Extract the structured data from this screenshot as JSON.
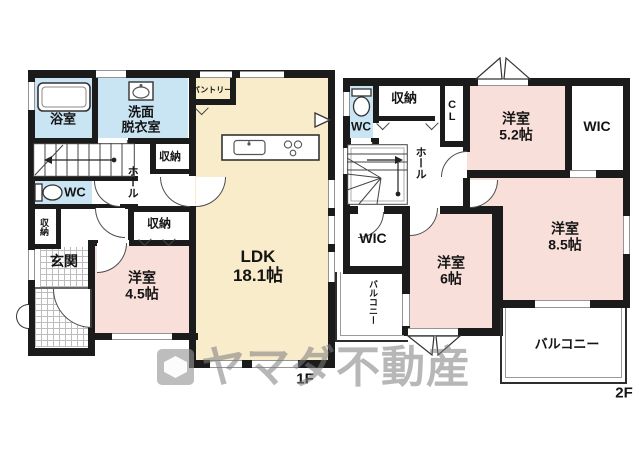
{
  "colors": {
    "wall": "#1b1b1b",
    "ldk": "#F8ECCB",
    "bedroom": "#F9DFD9",
    "wet": "#C9E4F2",
    "tile": "#bdbdbd",
    "wm": "#7d7d7d"
  },
  "floor1": {
    "label": "1F",
    "rooms": {
      "bath": {
        "label": "浴室"
      },
      "washroom": {
        "line1": "洗面",
        "line2": "脱衣室"
      },
      "pantry": {
        "label": "パントリー"
      },
      "storage_hall": {
        "label": "収納"
      },
      "hall": {
        "label": "ホール"
      },
      "wc": {
        "label": "WC"
      },
      "storage_side": {
        "label": "収納"
      },
      "entrance": {
        "label": "玄関"
      },
      "storage_west": {
        "label": "収納"
      },
      "western_room": {
        "name": "洋室",
        "size": "4.5帖"
      },
      "ldk": {
        "name": "LDK",
        "size": "18.1帖"
      }
    }
  },
  "floor2": {
    "label": "2F",
    "rooms": {
      "wc": {
        "label": "WC"
      },
      "storage": {
        "label": "収納"
      },
      "closet": {
        "label": "CL"
      },
      "western_52": {
        "name": "洋室",
        "size": "5.2帖"
      },
      "wic_ne": {
        "label": "WIC"
      },
      "hall": {
        "label": "ホール"
      },
      "wic_w": {
        "label": "WIC"
      },
      "balcony_w": {
        "label": "バルコニー"
      },
      "western_6": {
        "name": "洋室",
        "size": "6帖"
      },
      "western_85": {
        "name": "洋室",
        "size": "8.5帖"
      },
      "balcony_s": {
        "label": "バルコニー"
      }
    }
  },
  "watermark": {
    "brand": "ヤマダ不動産"
  }
}
